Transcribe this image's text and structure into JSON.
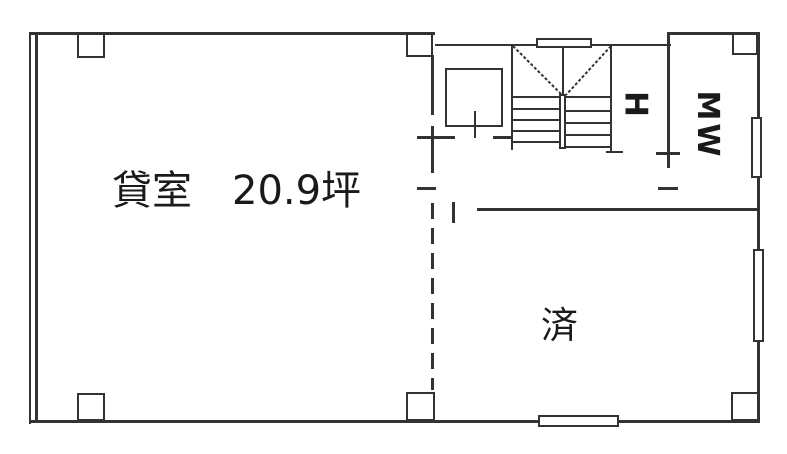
{
  "floorplan": {
    "title": "floor-plan",
    "room_label": "貸室　20.9坪",
    "room_area_tsubo": "20.9",
    "status_label": "済",
    "restroom_label": "MW",
    "hall_label": "H",
    "colors": {
      "wall": "#333333",
      "text": "#1a1a1a",
      "background": "#ffffff"
    }
  }
}
